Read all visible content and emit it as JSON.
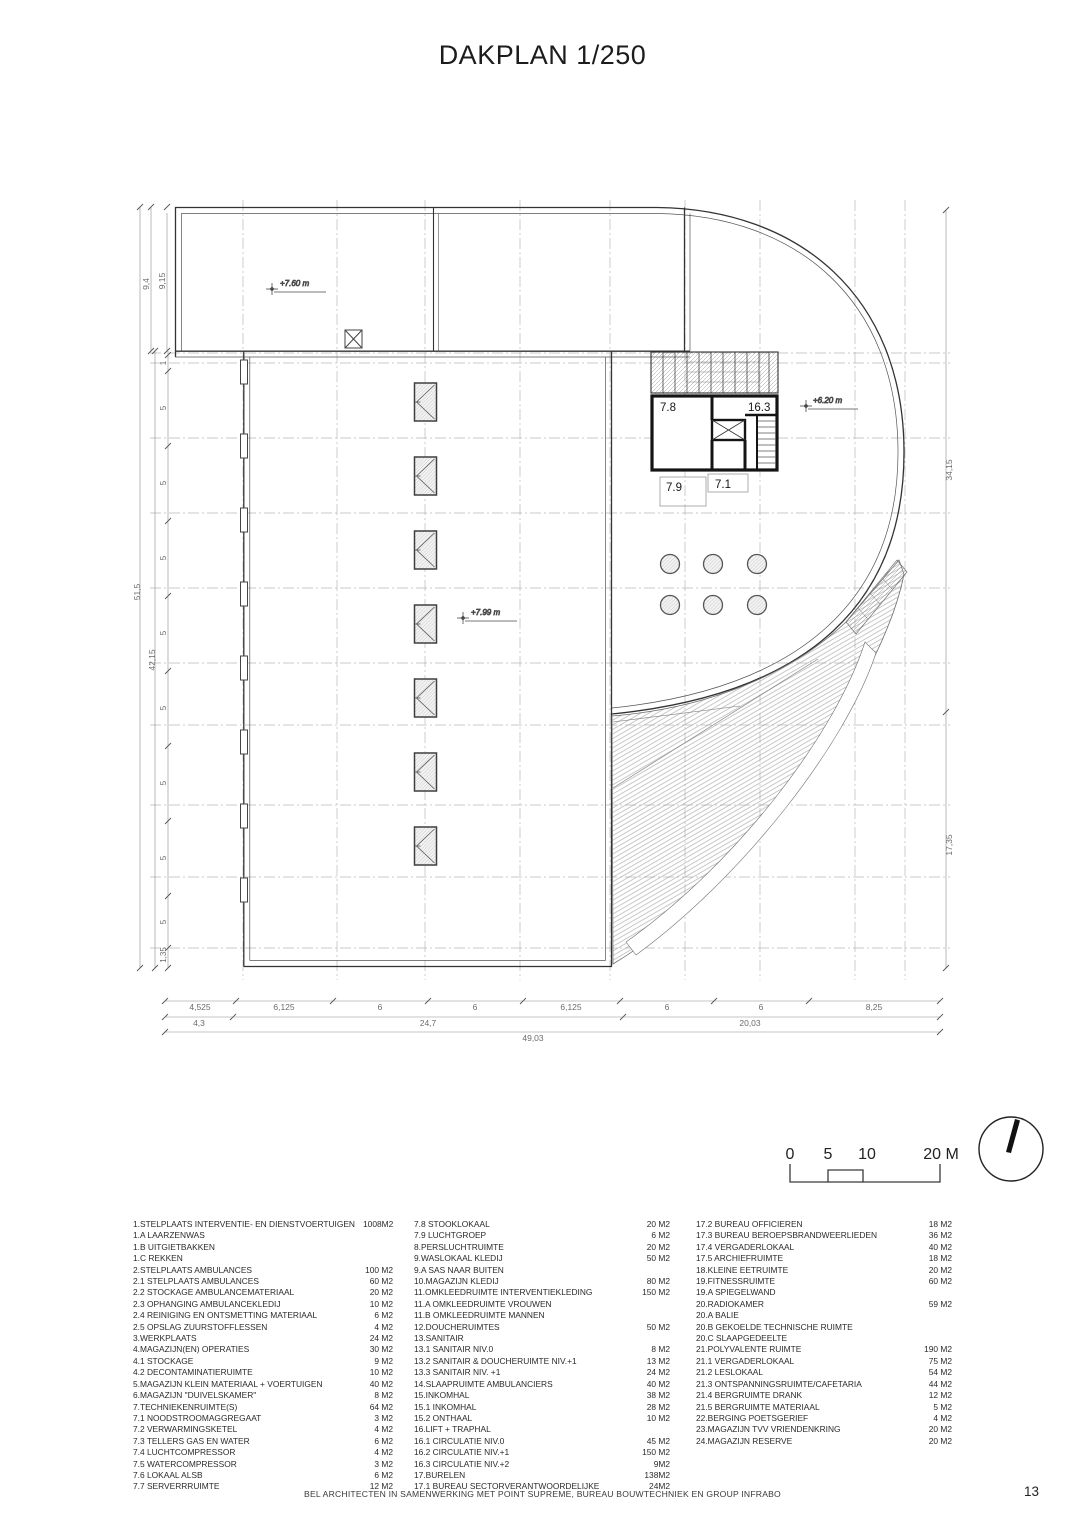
{
  "title": "DAKPLAN 1/250",
  "plan": {
    "levels": {
      "upper": "+7.60 m",
      "mid": "+7.99 m",
      "penthouse": "+6.20 m"
    },
    "rooms": {
      "r78": "7.8",
      "r163": "16.3",
      "r79": "7.9",
      "r71": "7.1"
    },
    "skylight_count": 7,
    "vent_circle_count": 6,
    "dims": {
      "left_outer": "51,5",
      "left_mid": "42,15",
      "left_top_outer": "9,4",
      "left_top_inner": "9,15",
      "left_ticks": [
        "1",
        "5",
        "5",
        "5",
        "5",
        "5",
        "5",
        "5",
        "5",
        "1,35"
      ],
      "right_top": "34,15",
      "right_bottom": "17,35",
      "bottom_row1": [
        "4,525",
        "6,125",
        "6",
        "6",
        "6,125",
        "6",
        "6",
        "8,25"
      ],
      "bottom_row2": [
        "4,3",
        "24,7",
        "20,03"
      ],
      "bottom_row3": "49,03"
    },
    "scalebar": {
      "labels": [
        "0",
        "5",
        "10",
        "20 M"
      ]
    }
  },
  "legend": {
    "columns": [
      {
        "rows": [
          {
            "label": "1.STELPLAATS INTERVENTIE- EN DIENSTVOERTUIGEN",
            "value": "1008M2"
          },
          {
            "label": "1.A LAARZENWAS",
            "value": ""
          },
          {
            "label": "1.B UITGIETBAKKEN",
            "value": ""
          },
          {
            "label": "1.C REKKEN",
            "value": ""
          },
          {
            "label": "2.STELPLAATS AMBULANCES",
            "value": "100 M2"
          },
          {
            "label": "2.1 STELPLAATS AMBULANCES",
            "value": "60 M2"
          },
          {
            "label": "2.2 STOCKAGE AMBULANCEMATERIAAL",
            "value": "20 M2"
          },
          {
            "label": "2.3 OPHANGING AMBULANCEKLEDIJ",
            "value": "10 M2"
          },
          {
            "label": "2.4 REINIGING EN ONTSMETTING MATERIAAL",
            "value": "6 M2"
          },
          {
            "label": "2.5 OPSLAG ZUURSTOFFLESSEN",
            "value": "4 M2"
          },
          {
            "label": "3.WERKPLAATS",
            "value": "24 M2"
          },
          {
            "label": "4.MAGAZIJN(EN) OPERATIES",
            "value": "30 M2"
          },
          {
            "label": "4.1 STOCKAGE",
            "value": "9 M2"
          },
          {
            "label": "4.2 DECONTAMINATIERUIMTE",
            "value": "10 M2"
          },
          {
            "label": "5.MAGAZIJN KLEIN MATERIAAL + VOERTUIGEN",
            "value": "40 M2"
          },
          {
            "label": "6.MAGAZIJN \"DUIVELSKAMER\"",
            "value": "8 M2"
          },
          {
            "label": "7.TECHNIEKENRUIMTE(S)",
            "value": "64 M2"
          },
          {
            "label": "7.1 NOODSTROOMAGGREGAAT",
            "value": "3 M2"
          },
          {
            "label": "7.2 VERWARMINGSKETEL",
            "value": "4 M2"
          },
          {
            "label": "7.3 TELLERS GAS EN WATER",
            "value": "6 M2"
          },
          {
            "label": "7.4 LUCHTCOMPRESSOR",
            "value": "4 M2"
          },
          {
            "label": "7.5 WATERCOMPRESSOR",
            "value": "3 M2"
          },
          {
            "label": "7.6 LOKAAL ALSB",
            "value": "6 M2"
          },
          {
            "label": "7.7 SERVERRRUIMTE",
            "value": "12 M2"
          }
        ]
      },
      {
        "rows": [
          {
            "label": "7.8 STOOKLOKAAL",
            "value": "20 M2"
          },
          {
            "label": "7.9 LUCHTGROEP",
            "value": "6 M2"
          },
          {
            "label": "8.PERSLUCHTRUIMTE",
            "value": "20 M2"
          },
          {
            "label": "9.WASLOKAAL KLEDIJ",
            "value": "50 M2"
          },
          {
            "label": "9.A SAS NAAR BUITEN",
            "value": ""
          },
          {
            "label": "10.MAGAZIJN KLEDIJ",
            "value": "80 M2"
          },
          {
            "label": "11.OMKLEEDRUIMTE INTERVENTIEKLEDING",
            "value": "150 M2"
          },
          {
            "label": "11.A OMKLEEDRUIMTE VROUWEN",
            "value": ""
          },
          {
            "label": "11.B OMKLEEDRUIMTE MANNEN",
            "value": ""
          },
          {
            "label": "12.DOUCHERUIMTES",
            "value": "50 M2"
          },
          {
            "label": "13.SANITAIR",
            "value": ""
          },
          {
            "label": "13.1 SANITAIR NIV.0",
            "value": "8 M2"
          },
          {
            "label": "13.2 SANITAIR & DOUCHERUIMTE  NIV.+1",
            "value": "13 M2"
          },
          {
            "label": "13.3 SANITAIR NIV. +1",
            "value": "24 M2"
          },
          {
            "label": "14.SLAAPRUIMTE AMBULANCIERS",
            "value": "40 M2"
          },
          {
            "label": "15.INKOMHAL",
            "value": "38 M2"
          },
          {
            "label": "15.1 INKOMHAL",
            "value": "28 M2"
          },
          {
            "label": "15.2 ONTHAAL",
            "value": "10 M2"
          },
          {
            "label": "16.LIFT + TRAPHAL",
            "value": ""
          },
          {
            "label": "16.1 CIRCULATIE NIV.0",
            "value": "45 M2"
          },
          {
            "label": "16.2 CIRCULATIE NIV.+1",
            "value": "150 M2"
          },
          {
            "label": "16.3 CIRCULATIE NIV.+2",
            "value": "9M2"
          },
          {
            "label": "17.BURELEN",
            "value": "138M2"
          },
          {
            "label": "17.1 BUREAU SECTORVERANTWOORDELIJKE",
            "value": "24M2"
          }
        ]
      },
      {
        "rows": [
          {
            "label": "17.2 BUREAU OFFICIEREN",
            "value": "18 M2"
          },
          {
            "label": "17.3 BUREAU BEROEPSBRANDWEERLIEDEN",
            "value": "36 M2"
          },
          {
            "label": "17.4 VERGADERLOKAAL",
            "value": "40 M2"
          },
          {
            "label": "17.5 ARCHIEFRUIMTE",
            "value": "18 M2"
          },
          {
            "label": "18.KLEINE EETRUIMTE",
            "value": "20 M2"
          },
          {
            "label": "19.FITNESSRUIMTE",
            "value": "60 M2"
          },
          {
            "label": "19.A SPIEGELWAND",
            "value": ""
          },
          {
            "label": "20.RADIOKAMER",
            "value": "59 M2"
          },
          {
            "label": "20.A BALIE",
            "value": ""
          },
          {
            "label": "20.B GEKOELDE TECHNISCHE RUIMTE",
            "value": ""
          },
          {
            "label": "20.C SLAAPGEDEELTE",
            "value": ""
          },
          {
            "label": "21.POLYVALENTE RUIMTE",
            "value": "190 M2"
          },
          {
            "label": "21.1 VERGADERLOKAAL",
            "value": "75 M2"
          },
          {
            "label": "21.2 LESLOKAAL",
            "value": "54 M2"
          },
          {
            "label": "21.3 ONTSPANNINGSRUIMTE/CAFETARIA",
            "value": "44 M2"
          },
          {
            "label": "21.4 BERGRUIMTE DRANK",
            "value": "12 M2"
          },
          {
            "label": "21.5 BERGRUIMTE MATERIAAL",
            "value": "5 M2"
          },
          {
            "label": "22.BERGING POETSGERIEF",
            "value": "4 M2"
          },
          {
            "label": "23.MAGAZIJN TVV VRIENDENKRING",
            "value": "20 M2"
          },
          {
            "label": "24.MAGAZIJN RESERVE",
            "value": "20 M2"
          }
        ]
      }
    ]
  },
  "footer": {
    "credit": "BEL ARCHITECTEN IN SAMENWERKING MET POINT SUPREME, BUREAU BOUWTECHNIEK EN GROUP INFRABO",
    "page": "13"
  }
}
